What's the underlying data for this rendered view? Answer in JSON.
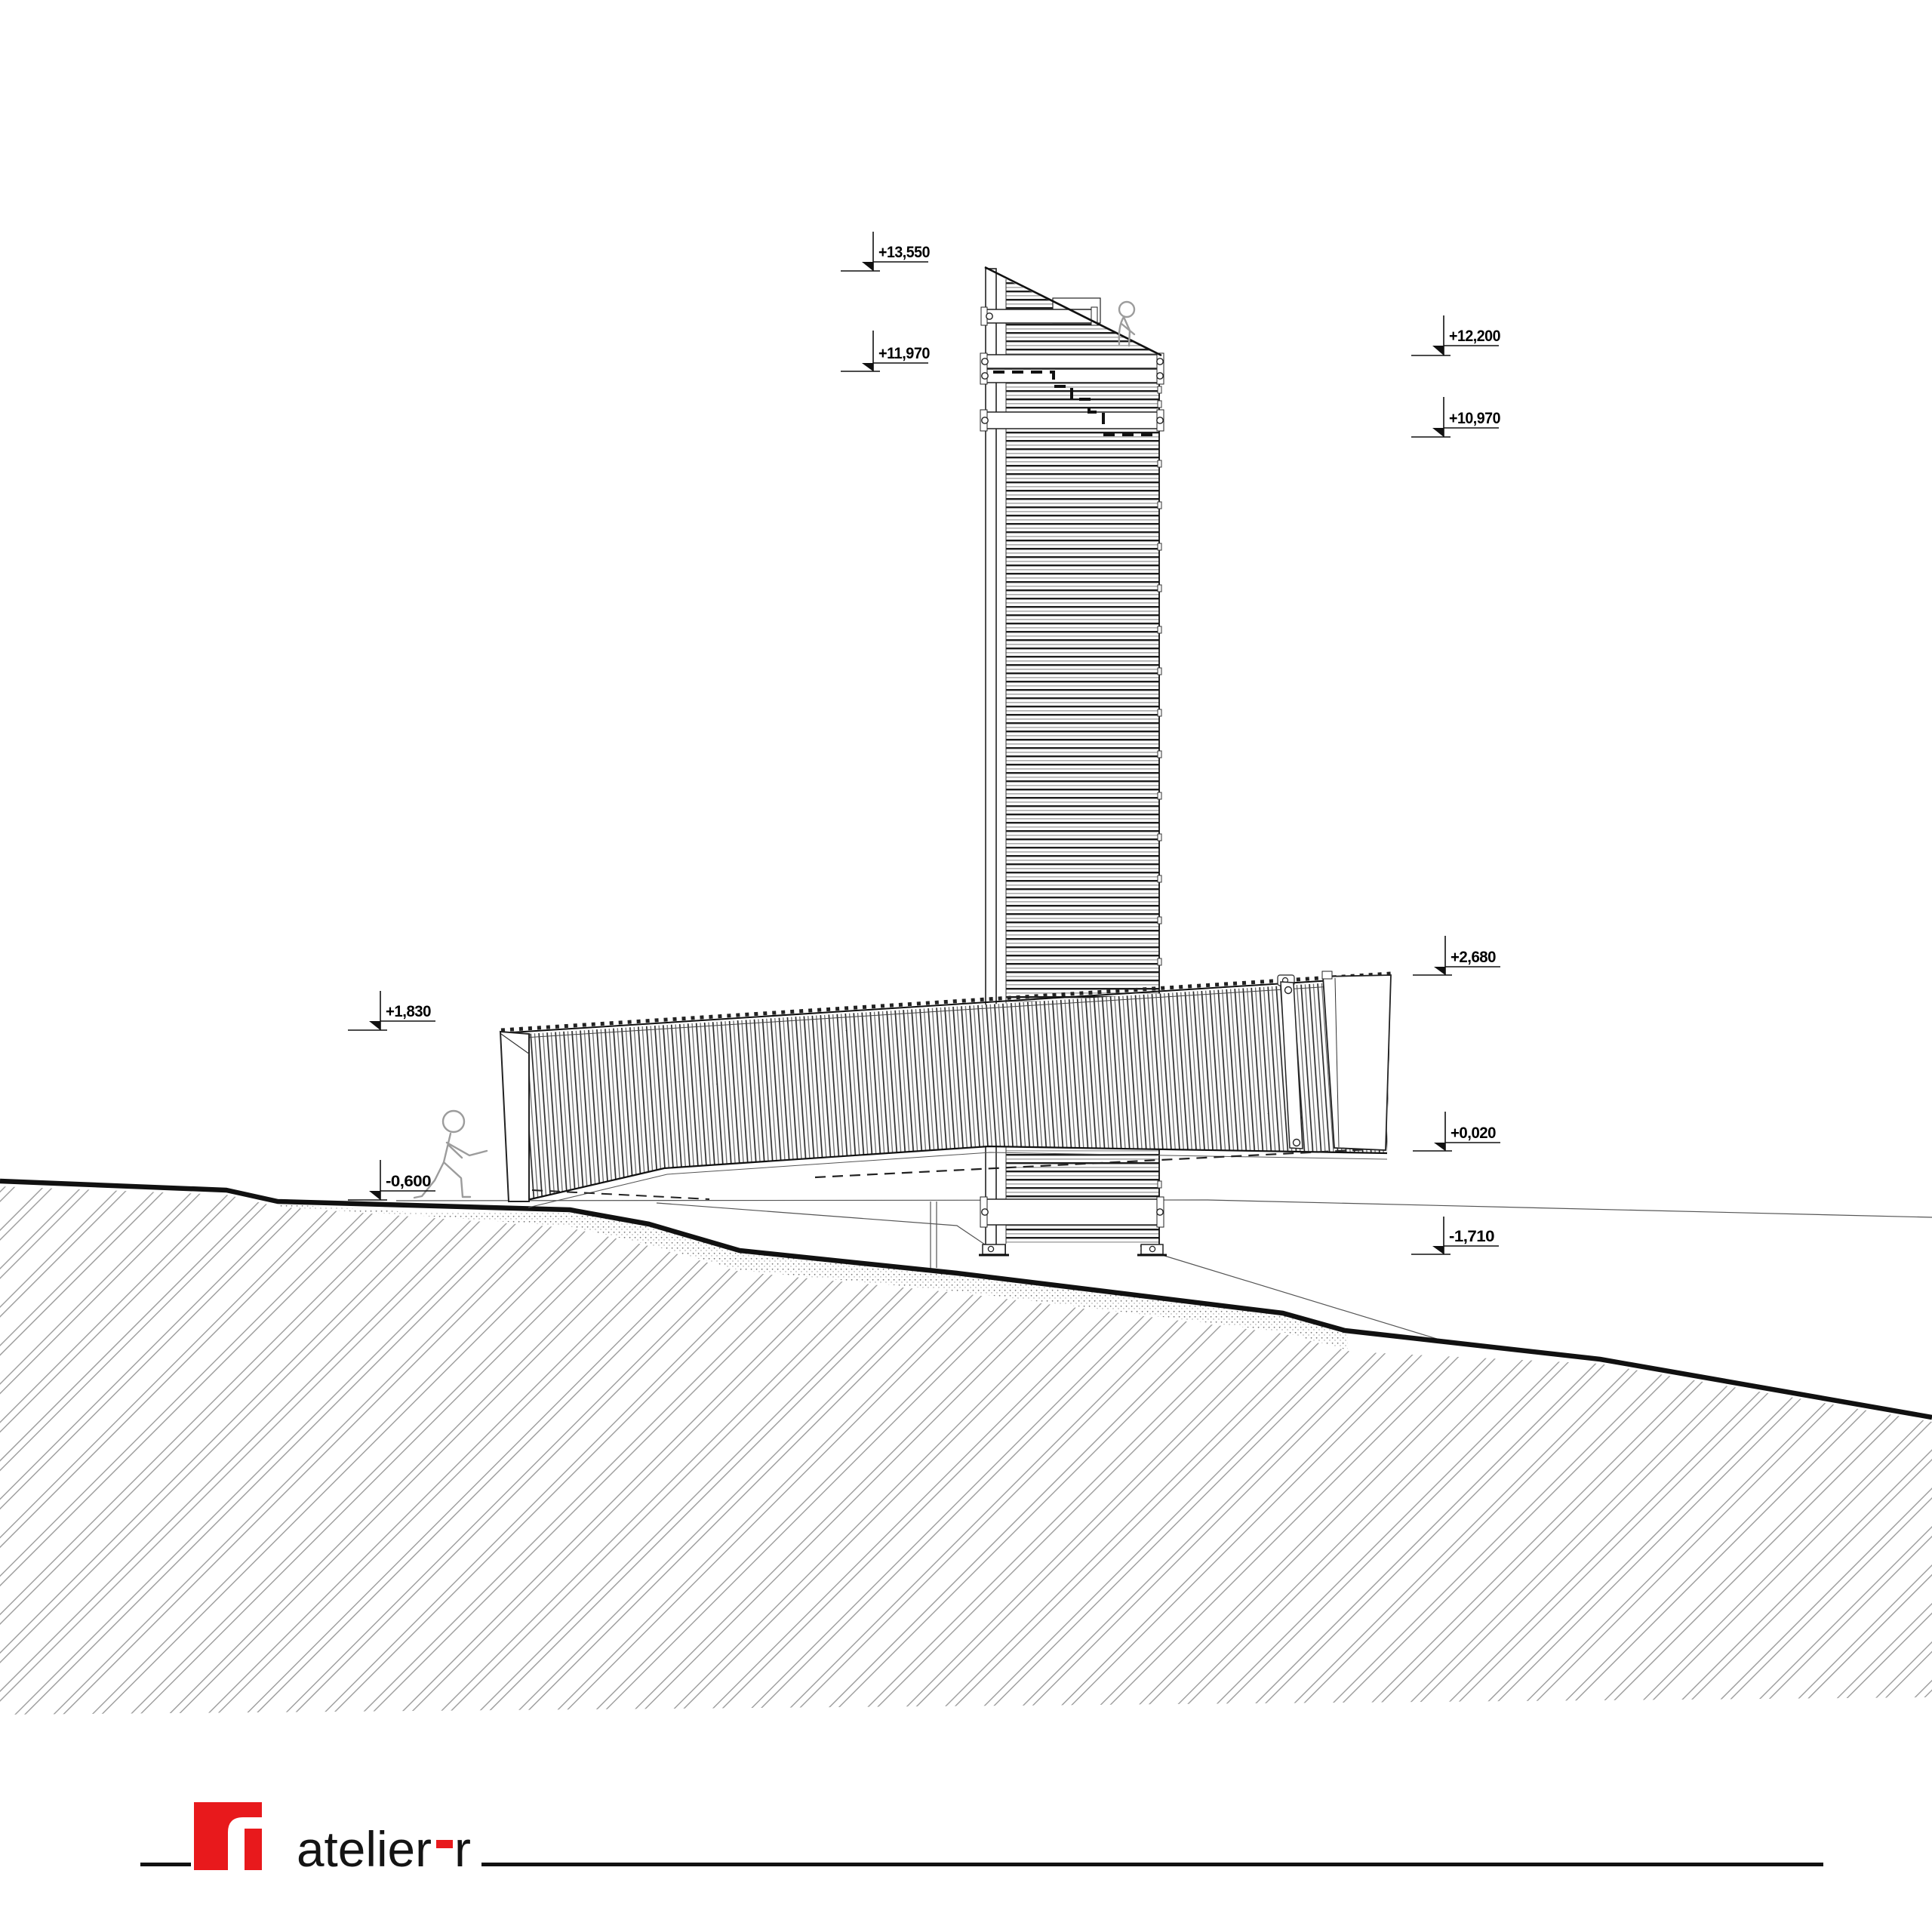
{
  "elevation_markers": [
    {
      "id": "level-plus-13550",
      "label": "+13,550"
    },
    {
      "id": "level-plus-11970",
      "label": "+11,970"
    },
    {
      "id": "level-plus-12200",
      "label": "+12,200"
    },
    {
      "id": "level-plus-10970",
      "label": "+10,970"
    },
    {
      "id": "level-plus-2680",
      "label": "+2,680"
    },
    {
      "id": "level-plus-0020",
      "label": "+0,020"
    },
    {
      "id": "level-minus-1710",
      "label": "-1,710"
    },
    {
      "id": "level-plus-1830",
      "label": "+1,830"
    },
    {
      "id": "level-minus-0600",
      "label": "-0,600"
    }
  ],
  "logo": {
    "brand_word": "atelier",
    "brand_suffix": "r",
    "full_name": "atelier-r",
    "accent_color": "#e8191c"
  },
  "colors": {
    "line_black": "#111111",
    "hatch_gray": "#999999",
    "stipple_gray": "#888888",
    "figure_gray": "#9c9c9c",
    "background": "#ffffff"
  }
}
